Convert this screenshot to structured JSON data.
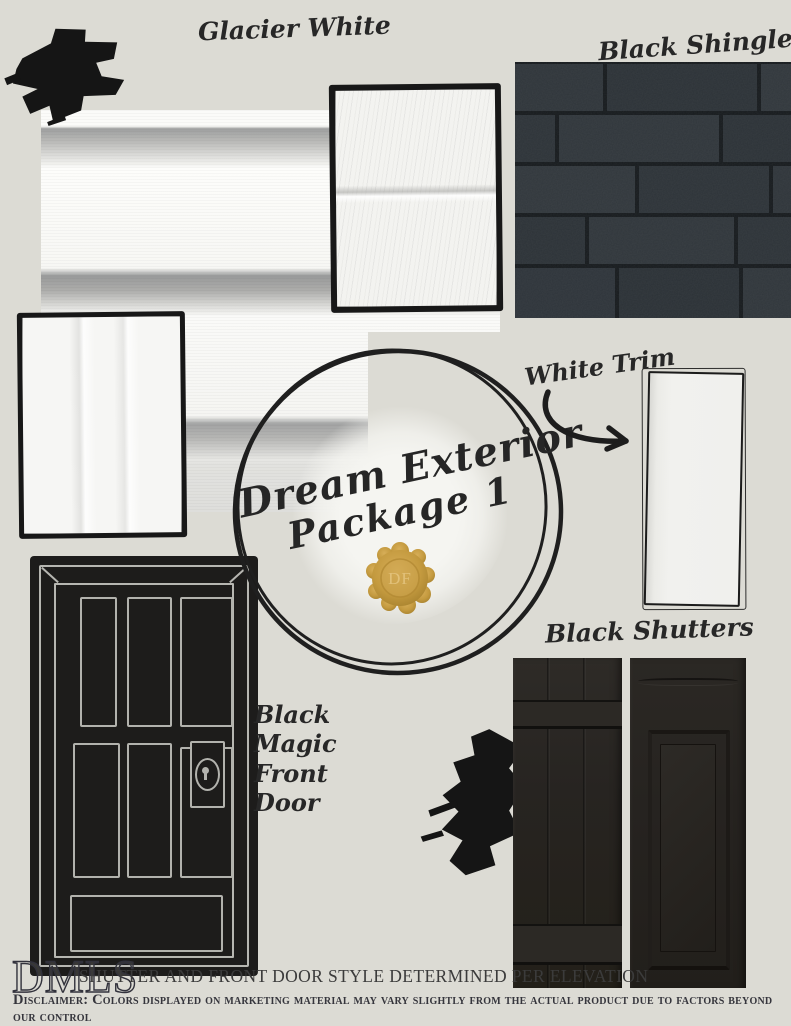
{
  "board": {
    "bg_color": "#dcdbd4",
    "ink_color": "#1a1a1a",
    "seal_gold": "#c49a3f"
  },
  "labels": {
    "siding_label": "Glacier White",
    "shingles_label": "Black Shingles",
    "trim_label": "White Trim",
    "shutters_label": "Black Shutters",
    "door_label_lines": [
      "Black",
      "Magic",
      "Front",
      "Door"
    ]
  },
  "badge": {
    "title_line1": "Dream Exterior",
    "title_line2": "Package 1",
    "seal_initials": "DF"
  },
  "footer": {
    "logo_text": "DMLS",
    "note": "SHUTTER AND FRONT DOOR STYLE DETERMINED PER ELEVATION",
    "disclaimer": "Disclaimer: Colors displayed on marketing material may vary slightly from the actual product due to factors beyond our control"
  }
}
